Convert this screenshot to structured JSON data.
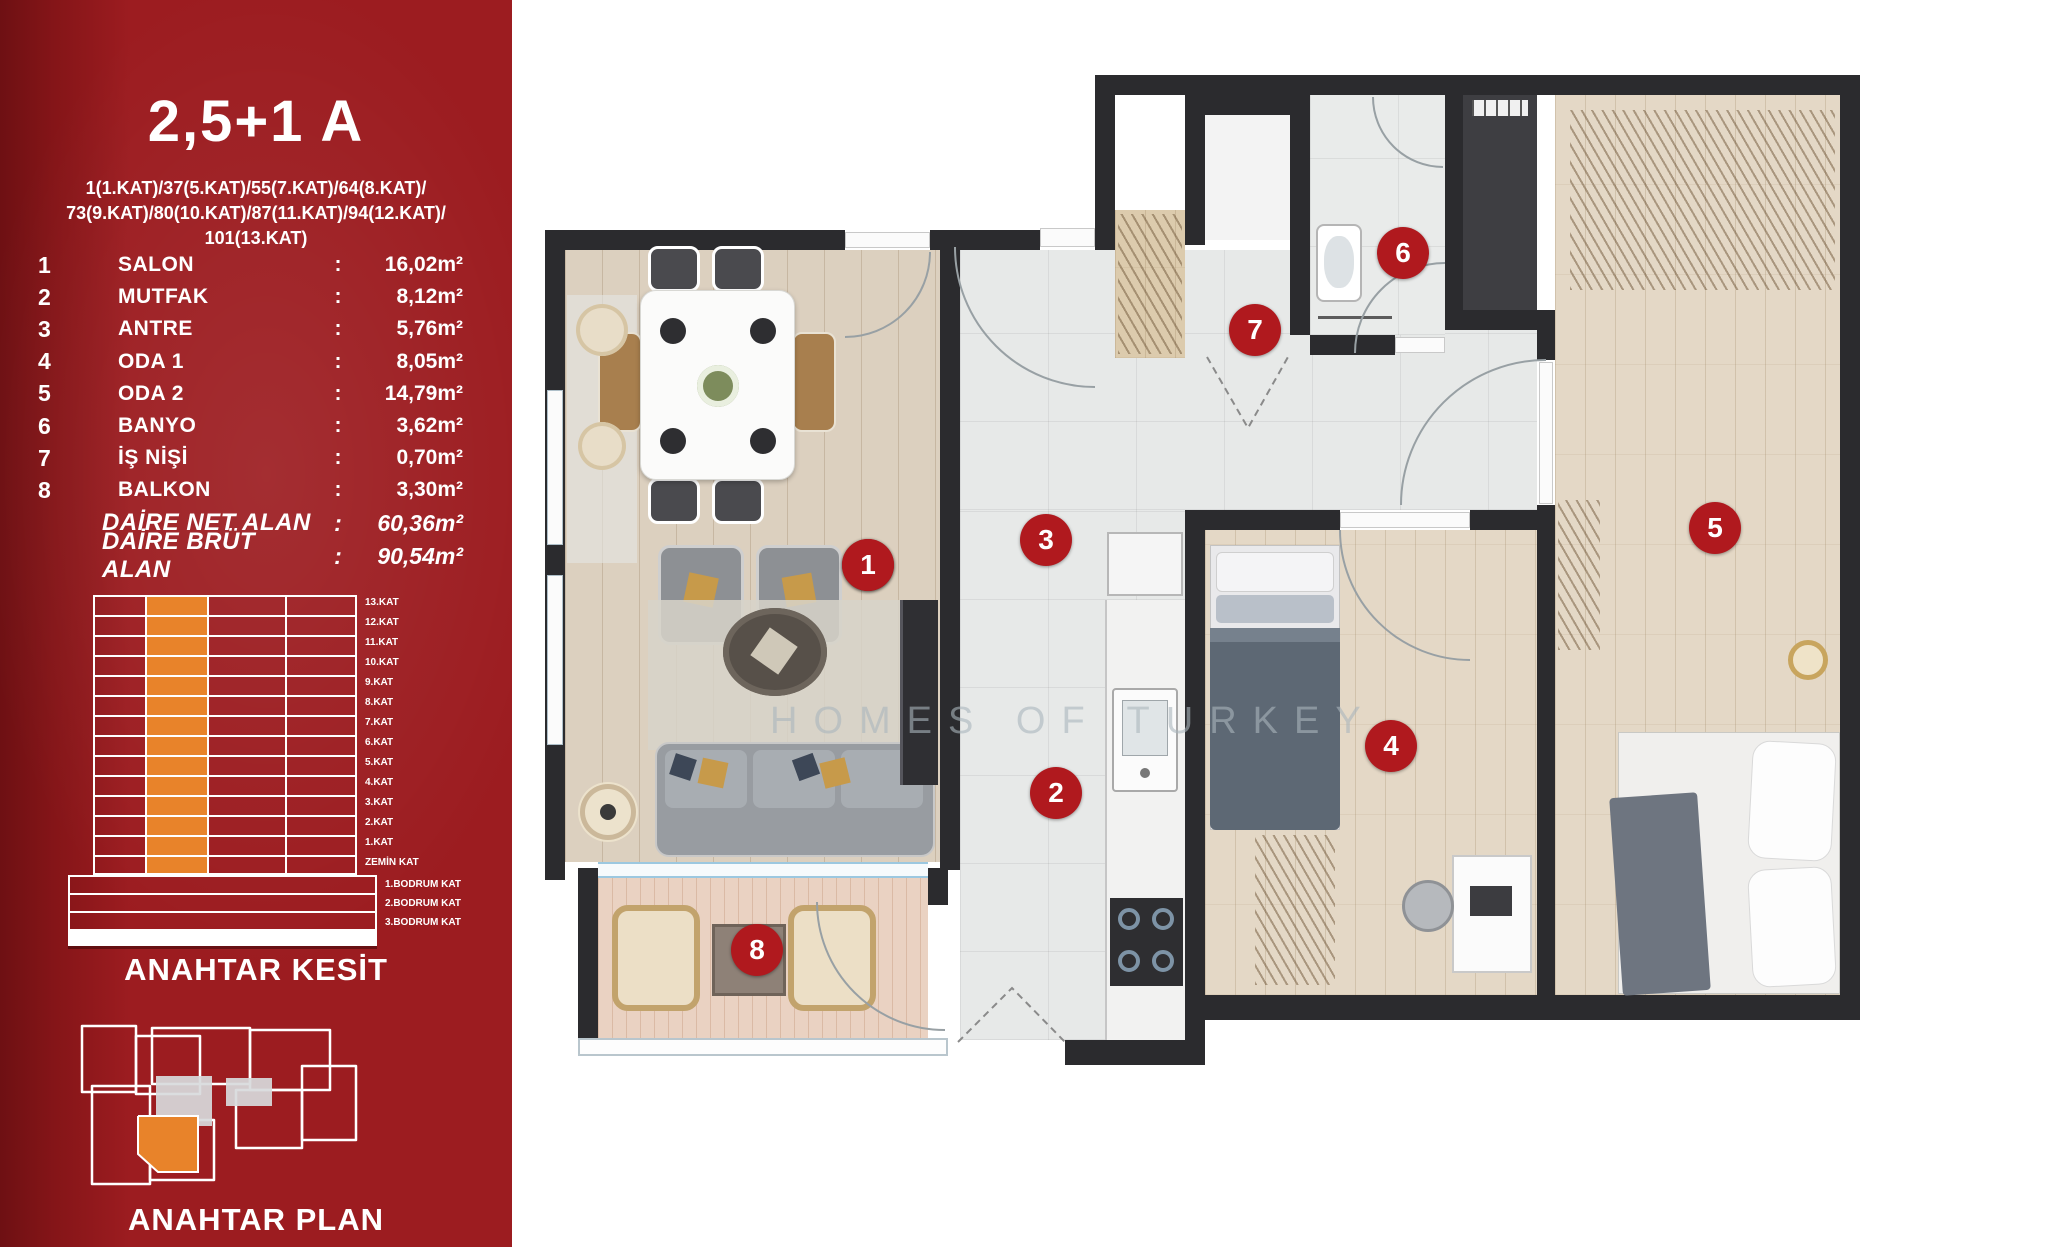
{
  "sidebar": {
    "title": "2,5+1 A",
    "floor_lines": [
      "1(1.KAT)/37(5.KAT)/55(7.KAT)/64(8.KAT)/",
      "73(9.KAT)/80(10.KAT)/87(11.KAT)/94(12.KAT)/",
      "101(13.KAT)"
    ],
    "colon": ":",
    "rooms": [
      {
        "num": "1",
        "name": "SALON",
        "area": "16,02m²"
      },
      {
        "num": "2",
        "name": "MUTFAK",
        "area": "8,12m²"
      },
      {
        "num": "3",
        "name": "ANTRE",
        "area": "5,76m²"
      },
      {
        "num": "4",
        "name": "ODA 1",
        "area": "8,05m²"
      },
      {
        "num": "5",
        "name": "ODA 2",
        "area": "14,79m²"
      },
      {
        "num": "6",
        "name": "BANYO",
        "area": "3,62m²"
      },
      {
        "num": "7",
        "name": "İŞ NİŞİ",
        "area": "0,70m²"
      },
      {
        "num": "8",
        "name": "BALKON",
        "area": "3,30m²"
      }
    ],
    "summary": [
      {
        "name": "DAİRE NET ALAN",
        "area": "60,36m²"
      },
      {
        "name": "DAİRE BRÜT ALAN",
        "area": "90,54m²"
      }
    ],
    "kesit": {
      "heading": "ANAHTAR KESİT",
      "floors": [
        "13.KAT",
        "12.KAT",
        "11.KAT",
        "10.KAT",
        "9.KAT",
        "8.KAT",
        "7.KAT",
        "6.KAT",
        "5.KAT",
        "4.KAT",
        "3.KAT",
        "2.KAT",
        "1.KAT",
        "ZEMİN KAT"
      ],
      "basements": [
        "1.BODRUM KAT",
        "2.BODRUM KAT",
        "3.BODRUM KAT"
      ],
      "highlight_color": "#e8832a"
    },
    "plan_key": {
      "heading": "ANAHTAR PLAN",
      "highlight_color": "#e8832a"
    },
    "panel_color": "#9c1c20"
  },
  "floorplan": {
    "watermark": "HOMES OF TURKEY",
    "badge_color": "#b0191e",
    "wall_color": "#2b2b2e",
    "badges": [
      {
        "num": "1"
      },
      {
        "num": "2"
      },
      {
        "num": "3"
      },
      {
        "num": "4"
      },
      {
        "num": "5"
      },
      {
        "num": "6"
      },
      {
        "num": "7"
      },
      {
        "num": "8"
      }
    ]
  }
}
